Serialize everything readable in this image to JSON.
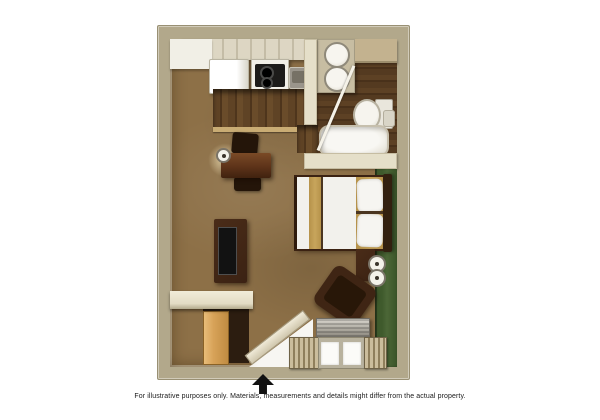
{
  "caption": {
    "text": "For illustrative purposes only.  Materials, measurements and details might differ from the actual property."
  },
  "entrance": {
    "icon": "entrance-arrow-up"
  },
  "plan": {
    "type": "studio-suite-floor-plan",
    "rooms": [
      "kitchen",
      "bathroom",
      "main-living-sleeping-area",
      "closet"
    ],
    "fixtures": [
      "refrigerator",
      "stove-cooktop",
      "kitchen-sink",
      "upper-cabinets",
      "bathroom-vanity-sink",
      "bathroom-vanity-sink",
      "toilet",
      "bathtub",
      "bed",
      "headboard",
      "pillows",
      "nightstand",
      "table-lamp",
      "desk",
      "desk-chair",
      "desk-chair",
      "desk-lamp",
      "tv-stand",
      "tv",
      "armchair",
      "closet-door",
      "entry-door",
      "bathroom-door",
      "ac-unit",
      "window",
      "curtains",
      "accent-wall"
    ]
  },
  "colors": {
    "wall_tan": "#b2a88b",
    "wall_light": "#e5dfc9",
    "carpet_brown": "#8d7047",
    "wood_dark": "#5d4125",
    "accent_green": "#4c6737",
    "furniture_wood": "#3b2213",
    "closet_door_tan": "#d7a258",
    "linen_white": "#f2f1ec",
    "stripe_gold": "#c7a55c",
    "caption_color": "#1a1a1a"
  }
}
